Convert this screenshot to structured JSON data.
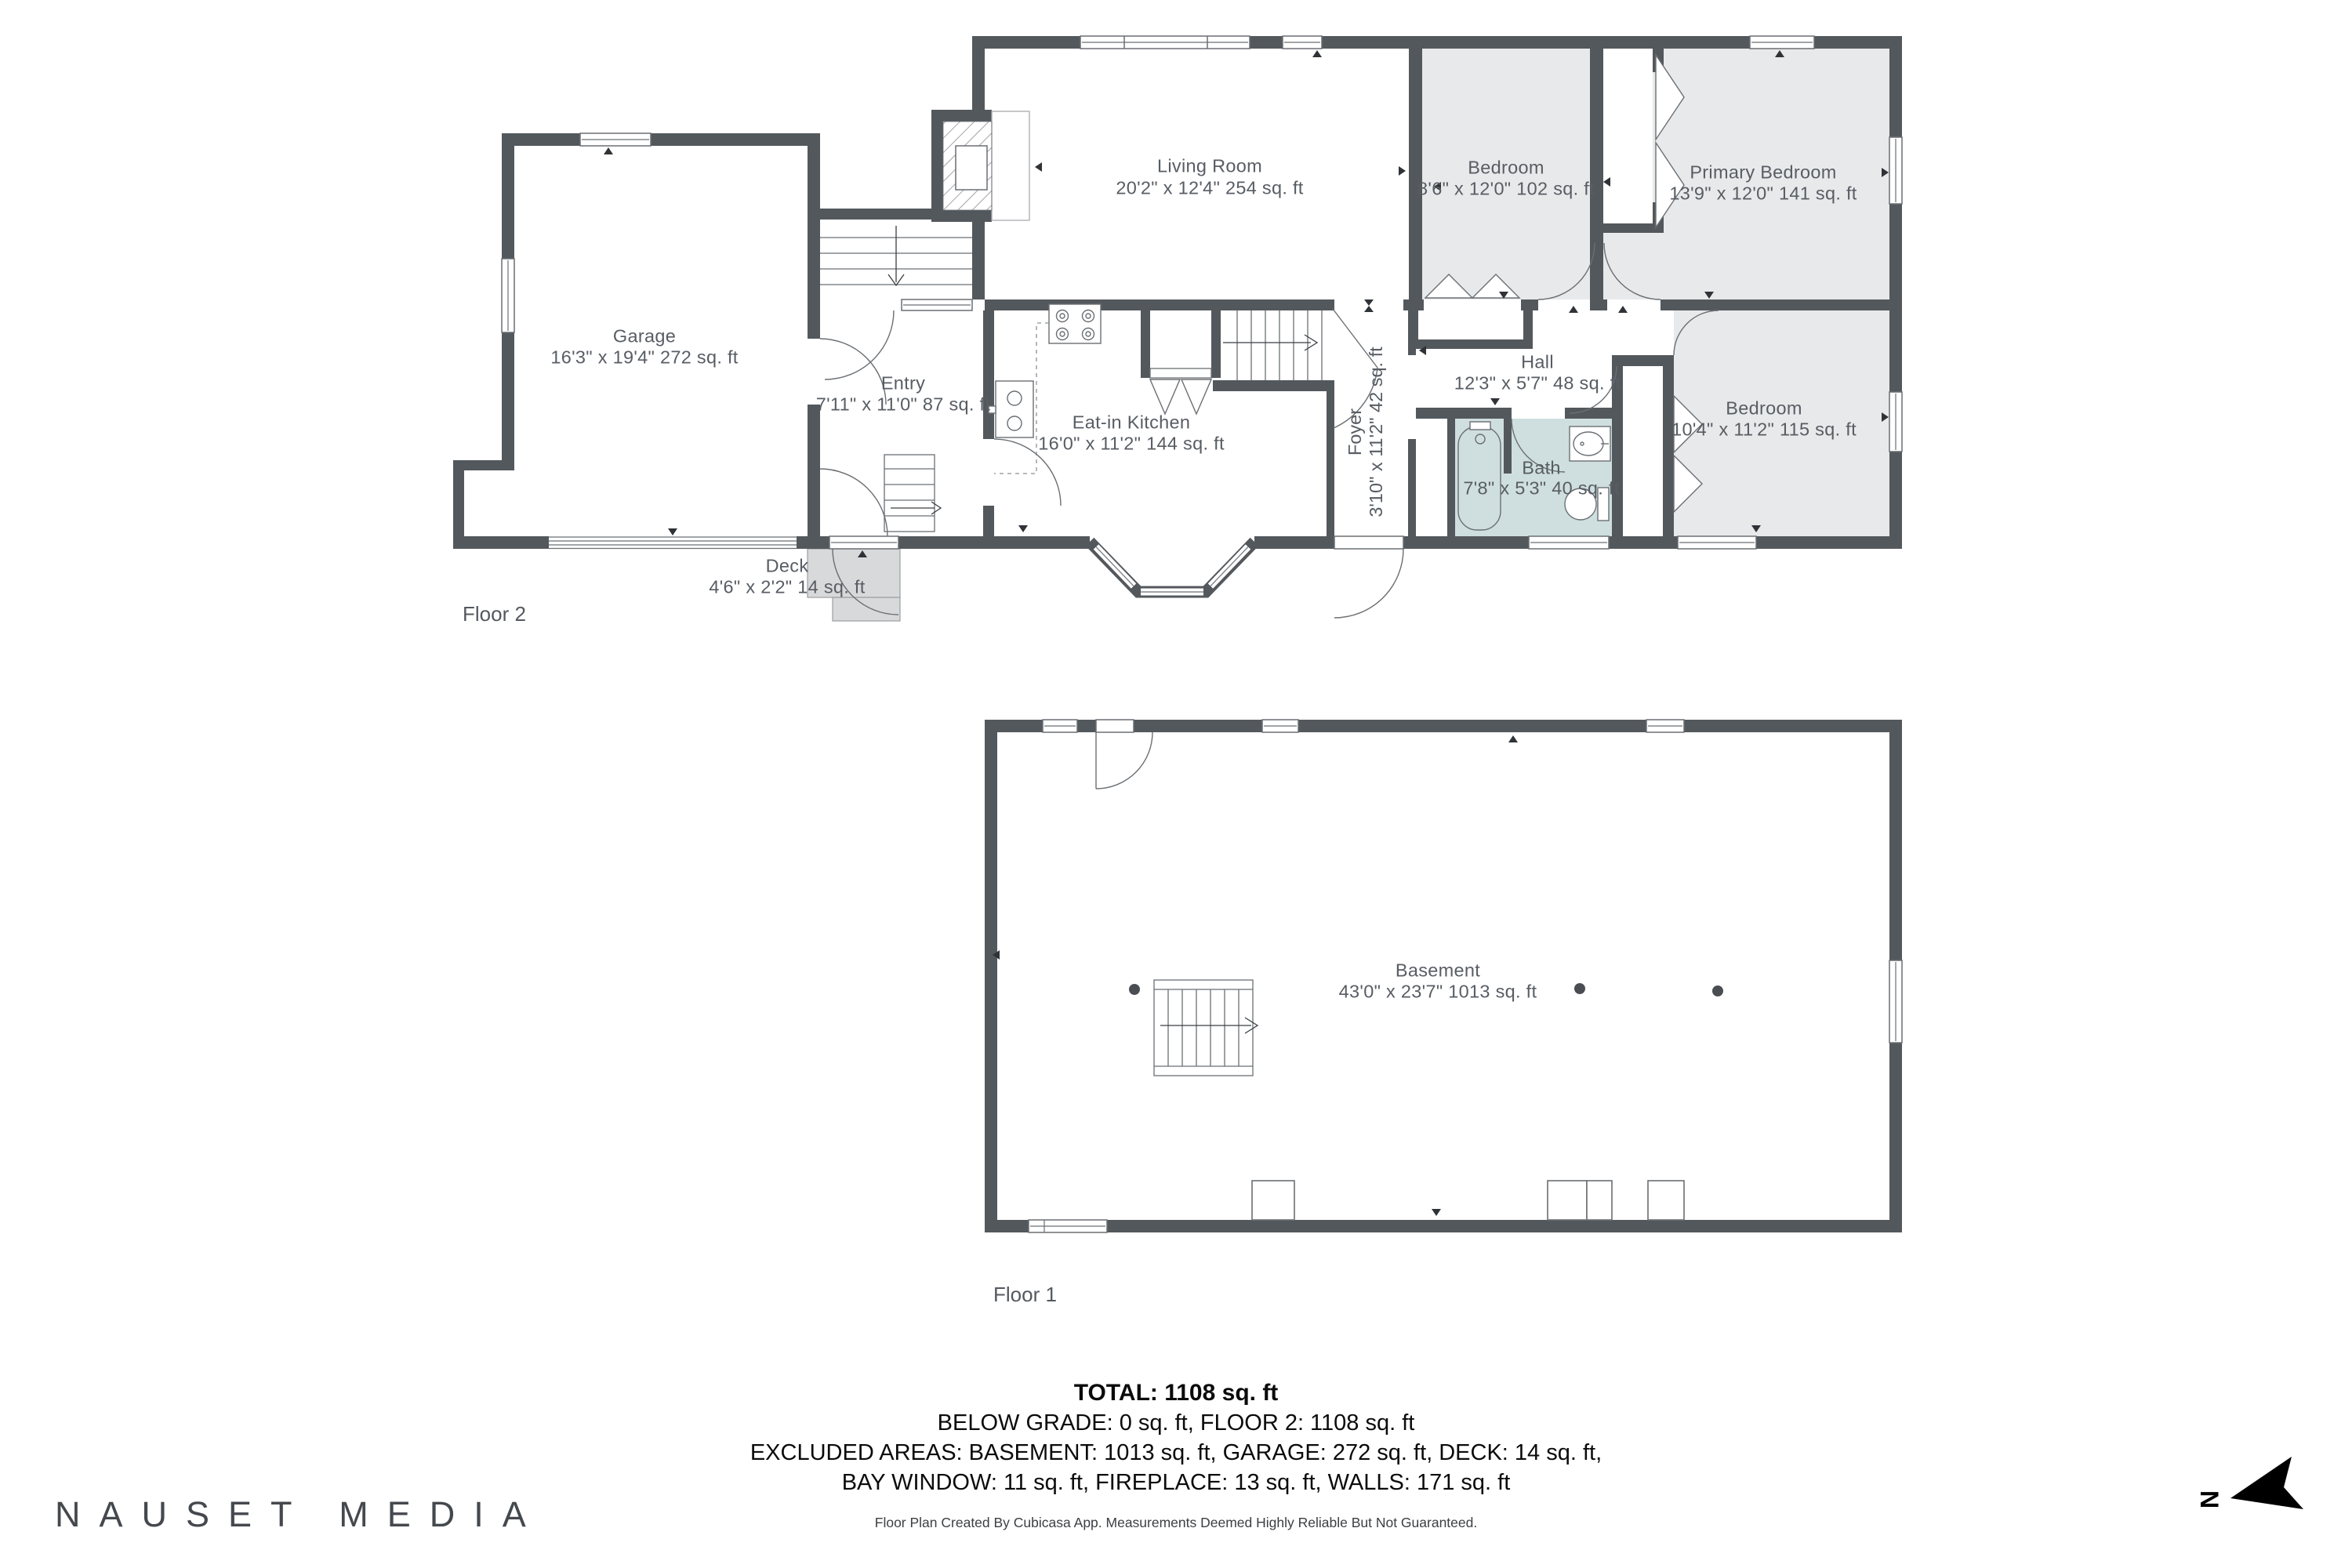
{
  "branding": {
    "logo_text": "NAUSET MEDIA",
    "disclaimer": "Floor Plan Created By Cubicasa App. Measurements Deemed Highly Reliable But Not Guaranteed."
  },
  "summary": {
    "total": "TOTAL: 1108 sq. ft",
    "below_grade_line": "BELOW GRADE: 0 sq. ft, FLOOR 2: 1108 sq. ft",
    "excluded_line_1": "EXCLUDED AREAS: BASEMENT: 1013 sq. ft, GARAGE: 272 sq. ft, DECK: 14 sq. ft,",
    "excluded_line_2": "BAY WINDOW: 11 sq. ft, FIREPLACE: 13 sq. ft, WALLS: 171 sq. ft"
  },
  "floor2": {
    "label": "Floor 2",
    "rooms": {
      "garage": {
        "name": "Garage",
        "dims": "16'3\" x 19'4\" 272 sq. ft"
      },
      "living": {
        "name": "Living Room",
        "dims": "20'2\" x 12'4\" 254 sq. ft"
      },
      "bedroom_small": {
        "name": "Bedroom",
        "dims": "8'6\" x 12'0\" 102 sq. ft"
      },
      "primary": {
        "name": "Primary Bedroom",
        "dims": "13'9\" x 12'0\" 141 sq. ft"
      },
      "entry": {
        "name": "Entry",
        "dims": "7'11\" x 11'0\" 87 sq. ft"
      },
      "kitchen": {
        "name": "Eat-in Kitchen",
        "dims": "16'0\" x 11'2\" 144 sq. ft"
      },
      "foyer": {
        "name": "Foyer",
        "dims": "3'10\" x 11'2\" 42 sq. ft"
      },
      "hall": {
        "name": "Hall",
        "dims": "12'3\" x 5'7\" 48 sq. ft"
      },
      "bath": {
        "name": "Bath",
        "dims": "7'8\" x 5'3\" 40 sq. ft"
      },
      "bedroom_right": {
        "name": "Bedroom",
        "dims": "10'4\" x 11'2\" 115 sq. ft"
      },
      "deck": {
        "name": "Deck",
        "dims": "4'6\" x 2'2\" 14 sq. ft"
      }
    }
  },
  "floor1": {
    "label": "Floor 1",
    "rooms": {
      "basement": {
        "name": "Basement",
        "dims": "43'0\" x 23'7\" 1013 sq. ft"
      }
    }
  },
  "compass": {
    "north": "N"
  },
  "colors": {
    "wall": "#53585d",
    "room_gray": "#e8e9ea",
    "bath_blue": "#cfdfdf",
    "deck_gray": "#d8d9da",
    "label_text": "#585d64"
  }
}
